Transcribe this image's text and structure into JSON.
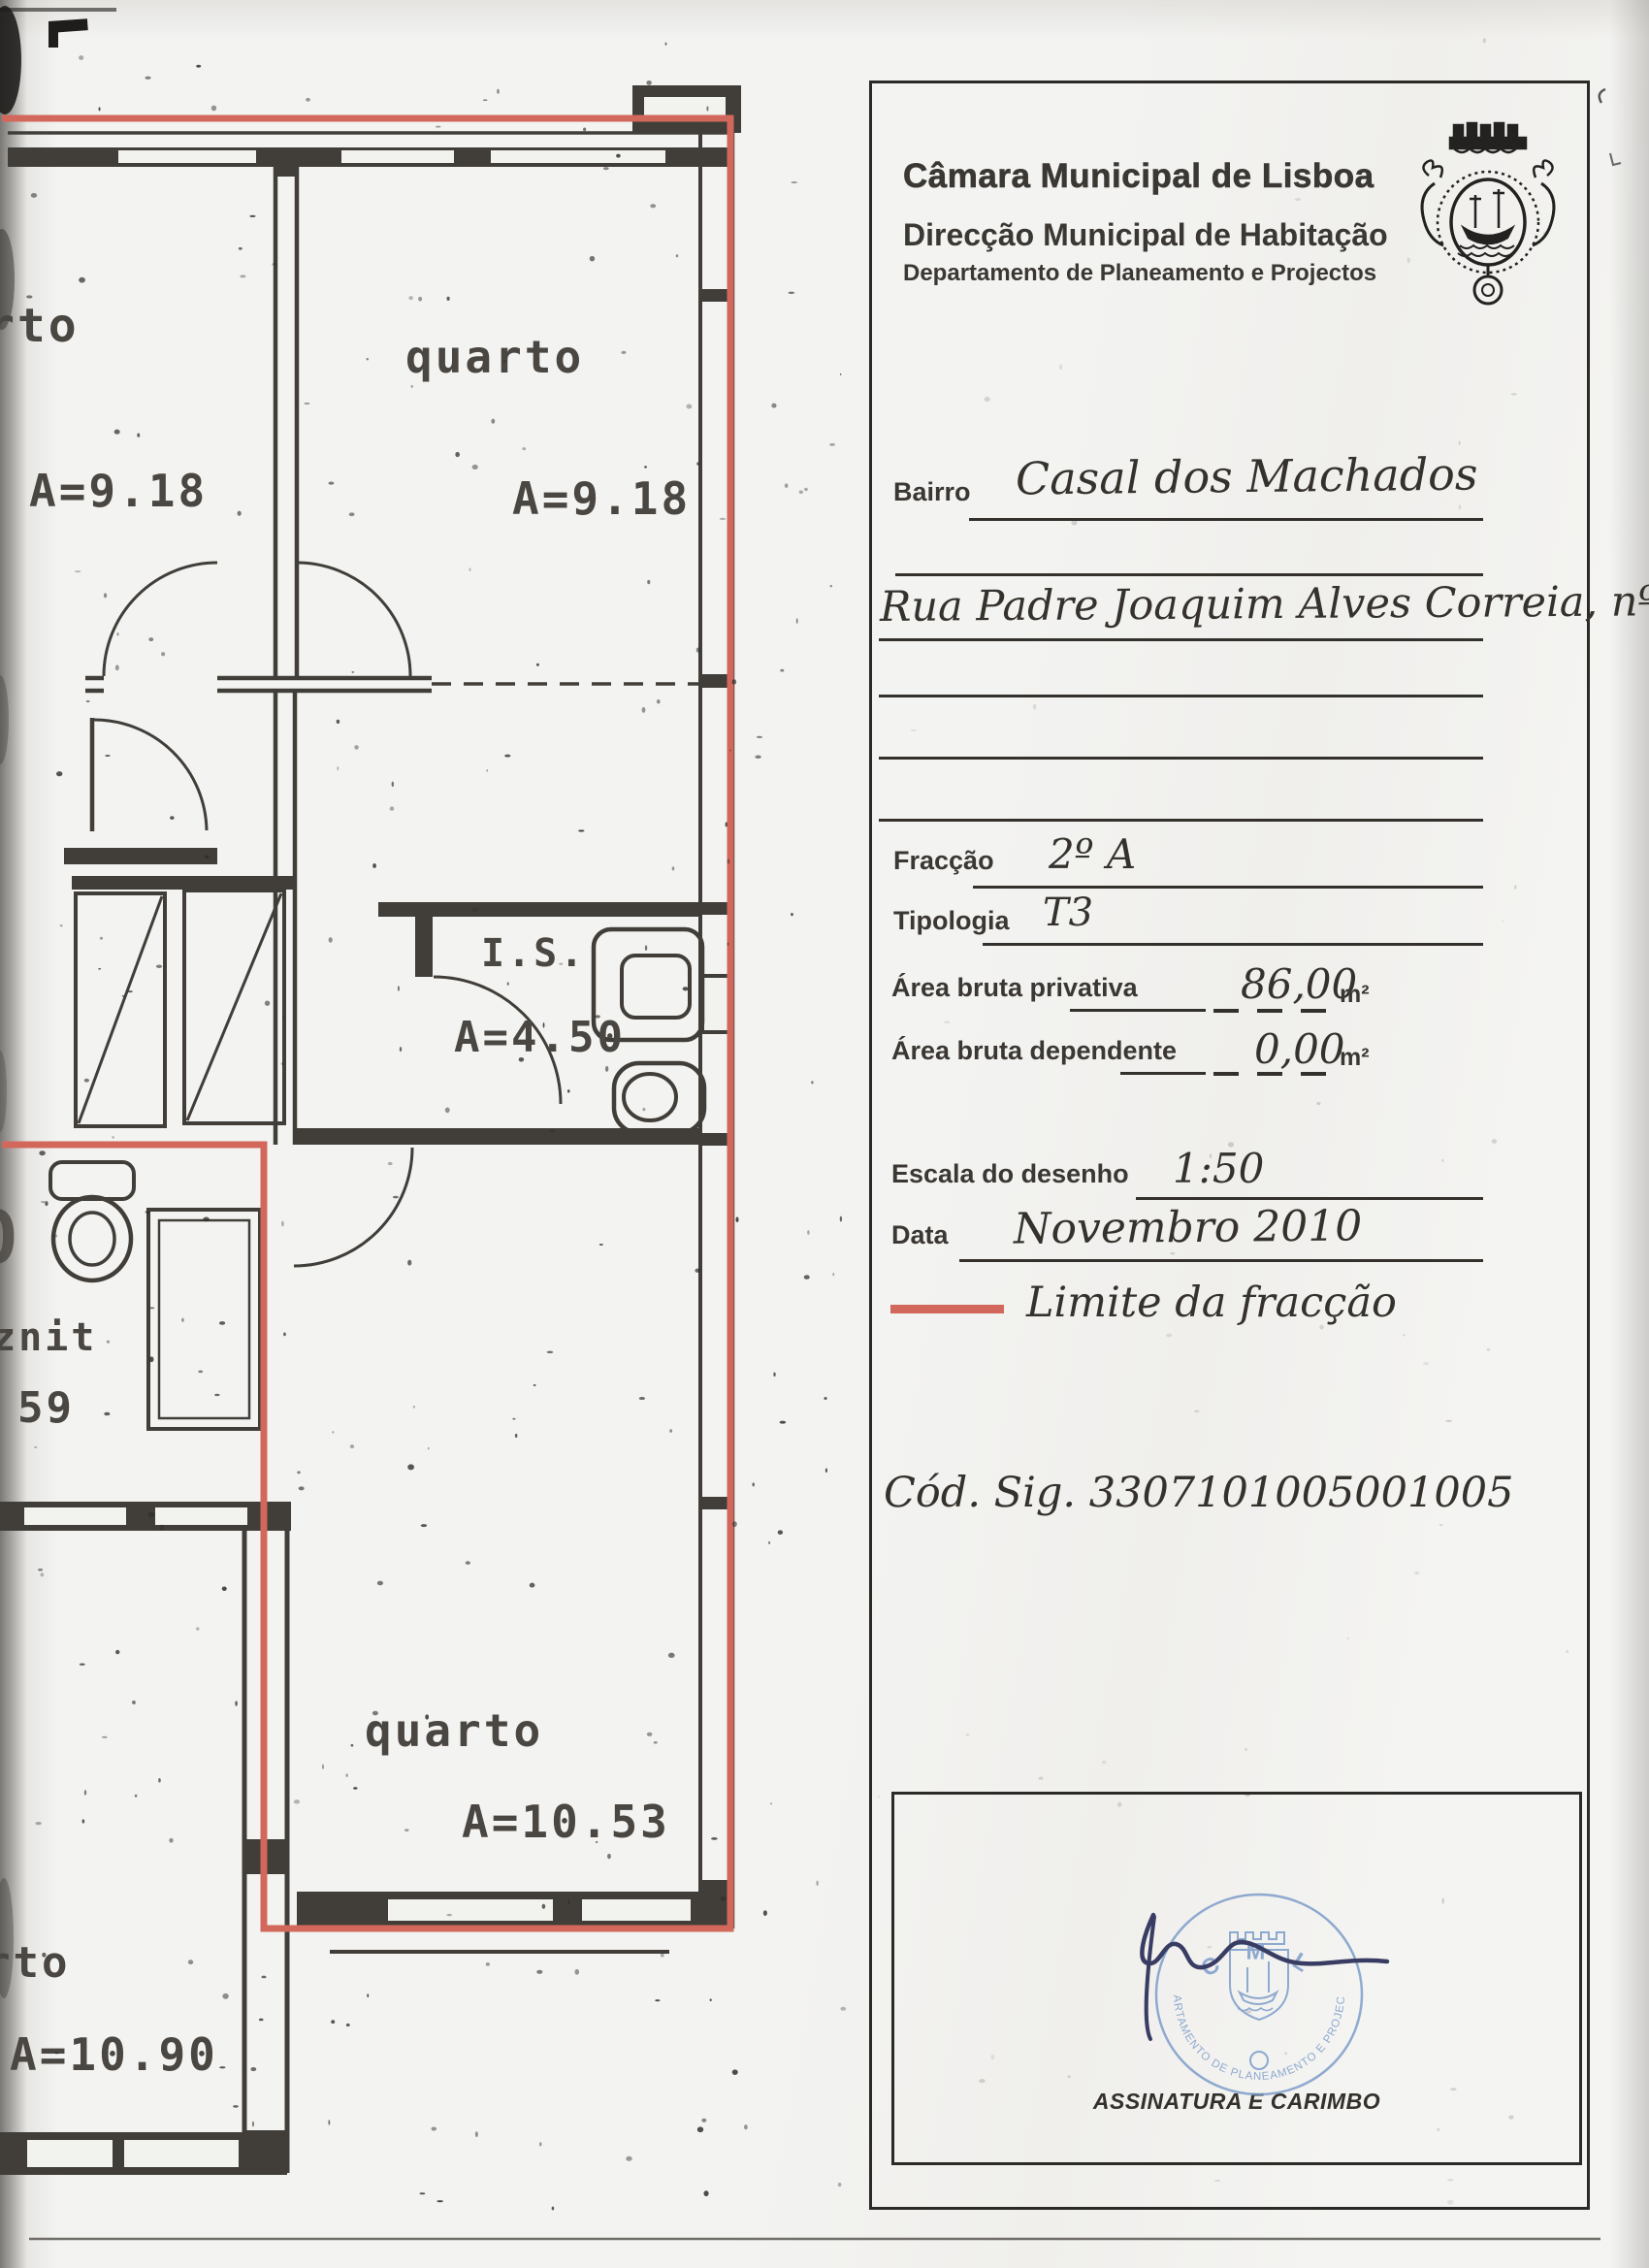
{
  "panel": {
    "org1": "Câmara Municipal de Lisboa",
    "org2": "Direcção Municipal de Habitação",
    "org3": "Departamento de Planeamento e Projectos",
    "fields": {
      "bairro_label": "Bairro",
      "bairro_value": "Casal dos Machados",
      "address_value": "Rua Padre Joaquim Alves Correia, nº 6",
      "fraccao_label": "Fracção",
      "fraccao_value": "2º A",
      "tipologia_label": "Tipologia",
      "tipologia_value": "T3",
      "area_privativa_label": "Área bruta privativa",
      "area_privativa_value": "86,00",
      "area_privativa_unit": "m²",
      "area_dependente_label": "Área bruta dependente",
      "area_dependente_value": "0,00",
      "area_dependente_unit": "m²",
      "escala_label": "Escala do desenho",
      "escala_value": "1:50",
      "data_label": "Data",
      "data_value": "Novembro 2010",
      "limite_label": "Limite da fracção",
      "cod_sig": "Cód. Sig. 3307101005001005"
    },
    "signature": {
      "box_label": "ASSINATURA E CARIMBO",
      "stamp_top": "C M L",
      "stamp_ring": "DEPARTAMENTO DE PLANEAMENTO E PROJECTOS"
    }
  },
  "plan": {
    "room_tl": {
      "label": "rto",
      "area": "A=9.18"
    },
    "room_tr": {
      "label": "quarto",
      "area": "A=9.18"
    },
    "bath": {
      "label": "I.S.",
      "area": "A=4.50"
    },
    "sanit": {
      "label": "znit",
      "area": "59",
      "cut_glyph": "O"
    },
    "room_b": {
      "label": "quarto",
      "area": "A=10.53"
    },
    "room_bl": {
      "label": "rto",
      "area": "A=10.90"
    }
  },
  "colors": {
    "fraction_red": "#d2685c",
    "wall": "#413e39",
    "stamp_blue": "#7d9dca",
    "signature_ink": "#3a3d63"
  }
}
